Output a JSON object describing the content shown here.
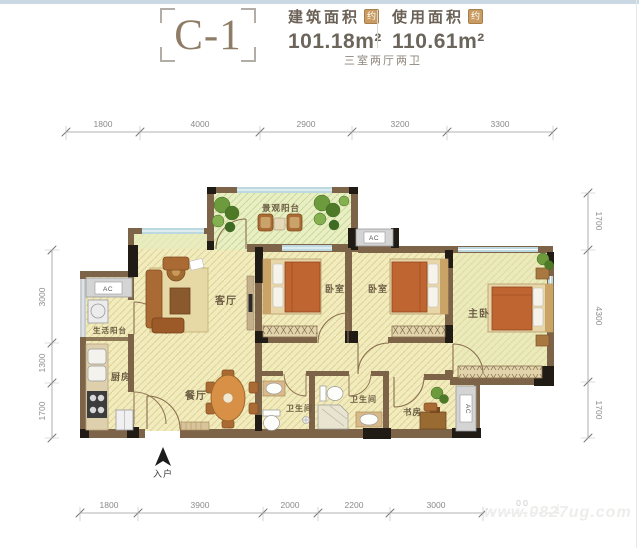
{
  "header": {
    "unit": "C-1",
    "metrics": [
      {
        "label": "建筑面积",
        "approx": "约",
        "value": "101.18m²"
      },
      {
        "label": "使用面积",
        "approx": "约",
        "value": "110.61m²"
      }
    ],
    "layout_summary": "三室两厅两卫"
  },
  "dimensions": {
    "top": [
      "1800",
      "4000",
      "2900",
      "3200",
      "3300"
    ],
    "bottom": [
      "1800",
      "3900",
      "2000",
      "2200",
      "3000"
    ],
    "bottom_faint": "0 0",
    "left": [
      "3000",
      "1300",
      "1700"
    ],
    "right": [
      "1700",
      "4300",
      "1700"
    ]
  },
  "rooms": {
    "view_balcony": "景观阳台",
    "living": "客厅",
    "dining": "餐厅",
    "kitchen": "厨房",
    "service_balcony": "生活阳台",
    "bedroom1": "卧室",
    "bedroom2": "卧室",
    "master": "主卧",
    "bath1": "卫生间",
    "bath2": "卫生间",
    "study": "书房"
  },
  "annotations": {
    "entrance": "入户",
    "ac": "AC"
  },
  "watermark": "www.0827ug.com",
  "colors": {
    "wall": "#7d6348",
    "wall_column": "#201b15",
    "floor": "#f2ebbe",
    "balcony_floor": "#e9efc4",
    "window": "#bcd9e1",
    "furniture_accent": "#bf6532",
    "badge": "#c99c63",
    "title_text": "#8e7c66"
  }
}
